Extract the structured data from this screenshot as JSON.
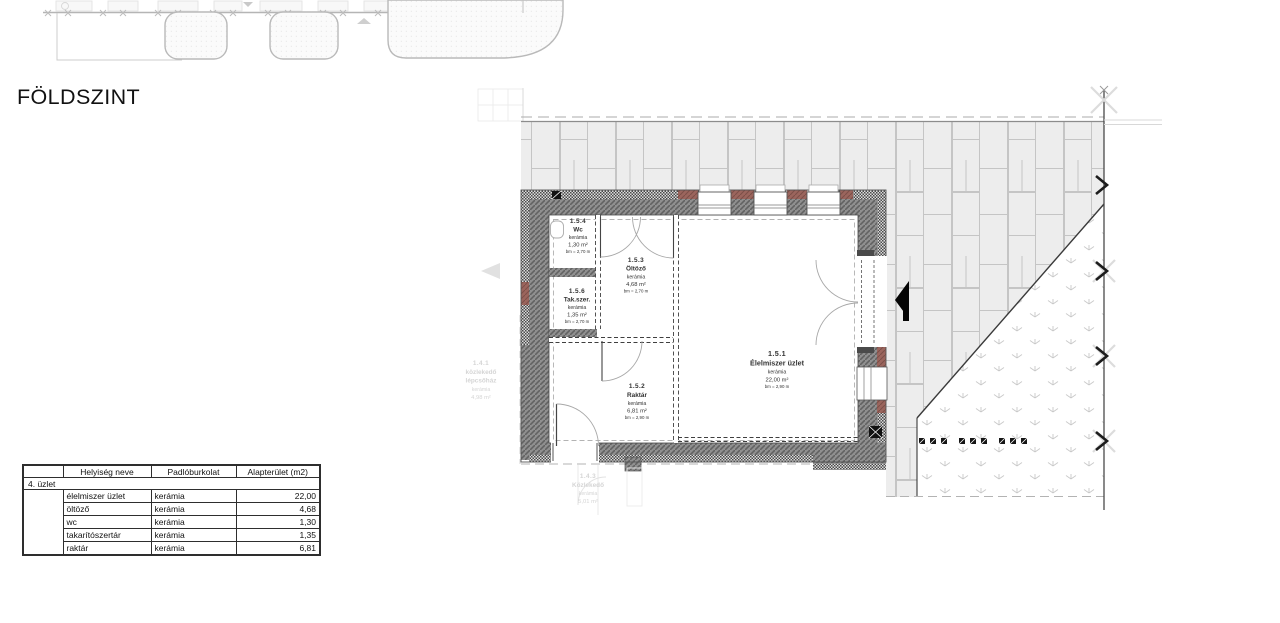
{
  "page": {
    "title": "FÖLDSZINT"
  },
  "plan": {
    "rooms": [
      {
        "id": "1.5.1",
        "name": "Élelmiszer üzlet",
        "floor": "kerámia",
        "area": "22,00 m²",
        "height": "bm = 2,90 m"
      },
      {
        "id": "1.5.2",
        "name": "Raktár",
        "floor": "kerámia",
        "area": "6,81 m²",
        "height": "bm = 2,90 m"
      },
      {
        "id": "1.5.3",
        "name": "Öltöző",
        "floor": "kerámia",
        "area": "4,68 m²",
        "height": "bm = 2,70 m"
      },
      {
        "id": "1.5.4",
        "name": "Wc",
        "floor": "kerámia",
        "area": "1,30 m²",
        "height": "bm = 2,70 m"
      },
      {
        "id": "1.5.6",
        "name": "Tak.szer.",
        "floor": "kerámia",
        "area": "1,35 m²",
        "height": "bm = 2,70 m"
      }
    ],
    "faded_rooms": [
      {
        "id": "1.4.1",
        "line1": "közlekedő",
        "line2": "lépcsőház",
        "floor": "kerámia",
        "area": "4,98 m²"
      },
      {
        "id": "1.4.3",
        "line1": "Közlekedő",
        "floor": "kerámia",
        "area": "5,01 m²"
      }
    ]
  },
  "table": {
    "headers": {
      "col0": "",
      "col1": "Helyiség neve",
      "col2": "Padlóburkolat",
      "col3": "Alapterület (m2)"
    },
    "group_label": "4. üzlet",
    "rows": [
      {
        "name": "élelmiszer üzlet",
        "floor": "kerámia",
        "area": "22,00"
      },
      {
        "name": "öltöző",
        "floor": "kerámia",
        "area": "4,68"
      },
      {
        "name": "wc",
        "floor": "kerámia",
        "area": "1,30"
      },
      {
        "name": "takarítószertár",
        "floor": "kerámia",
        "area": "1,35"
      },
      {
        "name": "raktár",
        "floor": "kerámia",
        "area": "6,81"
      }
    ]
  },
  "colors": {
    "wall": "#8f8f8f",
    "brick": "#9b655d",
    "paving_stone": "#ededed",
    "paving_joint": "#c5c5c5"
  }
}
